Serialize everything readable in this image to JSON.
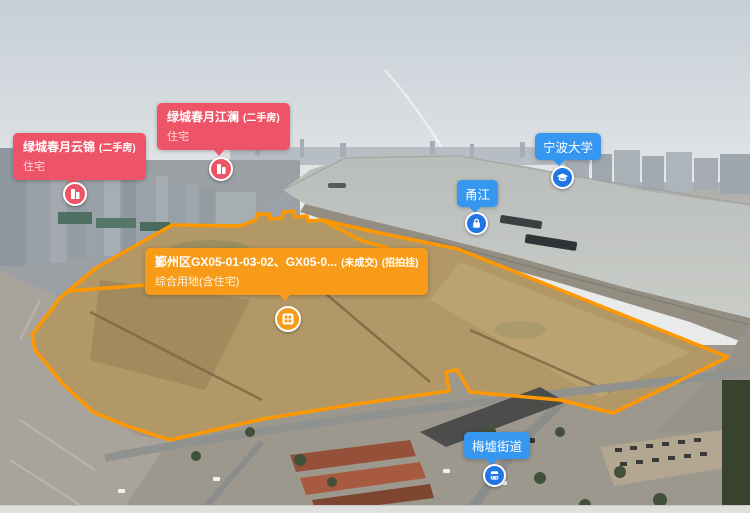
{
  "map": {
    "type": "aerial-panorama",
    "colors": {
      "listing_red": "#ee5467",
      "parcel_orange": "#f79b18",
      "parcel_outline": "#ff9800",
      "place_blue": "#3697f0",
      "place_pin_blue": "#2276e3"
    },
    "listings": [
      {
        "title": "绿城春月云锦",
        "tag": "(二手房)",
        "subtitle": "住宅",
        "icon": "building-icon"
      },
      {
        "title": "绿城春月江澜",
        "tag": "(二手房)",
        "subtitle": "住宅",
        "icon": "building-icon"
      }
    ],
    "parcel": {
      "title": "鄞州区GX05-01-03-02、GX05-0...",
      "status_tag": "(未成交)",
      "sale_tag": "(招拍挂)",
      "subtitle": "综合用地(含住宅)",
      "icon": "land-grid-icon"
    },
    "places": [
      {
        "label": "宁波大学",
        "icon": "university-icon"
      },
      {
        "label": "甬江",
        "icon": "river-lock-icon"
      },
      {
        "label": "梅墟街道",
        "icon": "bus-street-icon"
      }
    ]
  }
}
